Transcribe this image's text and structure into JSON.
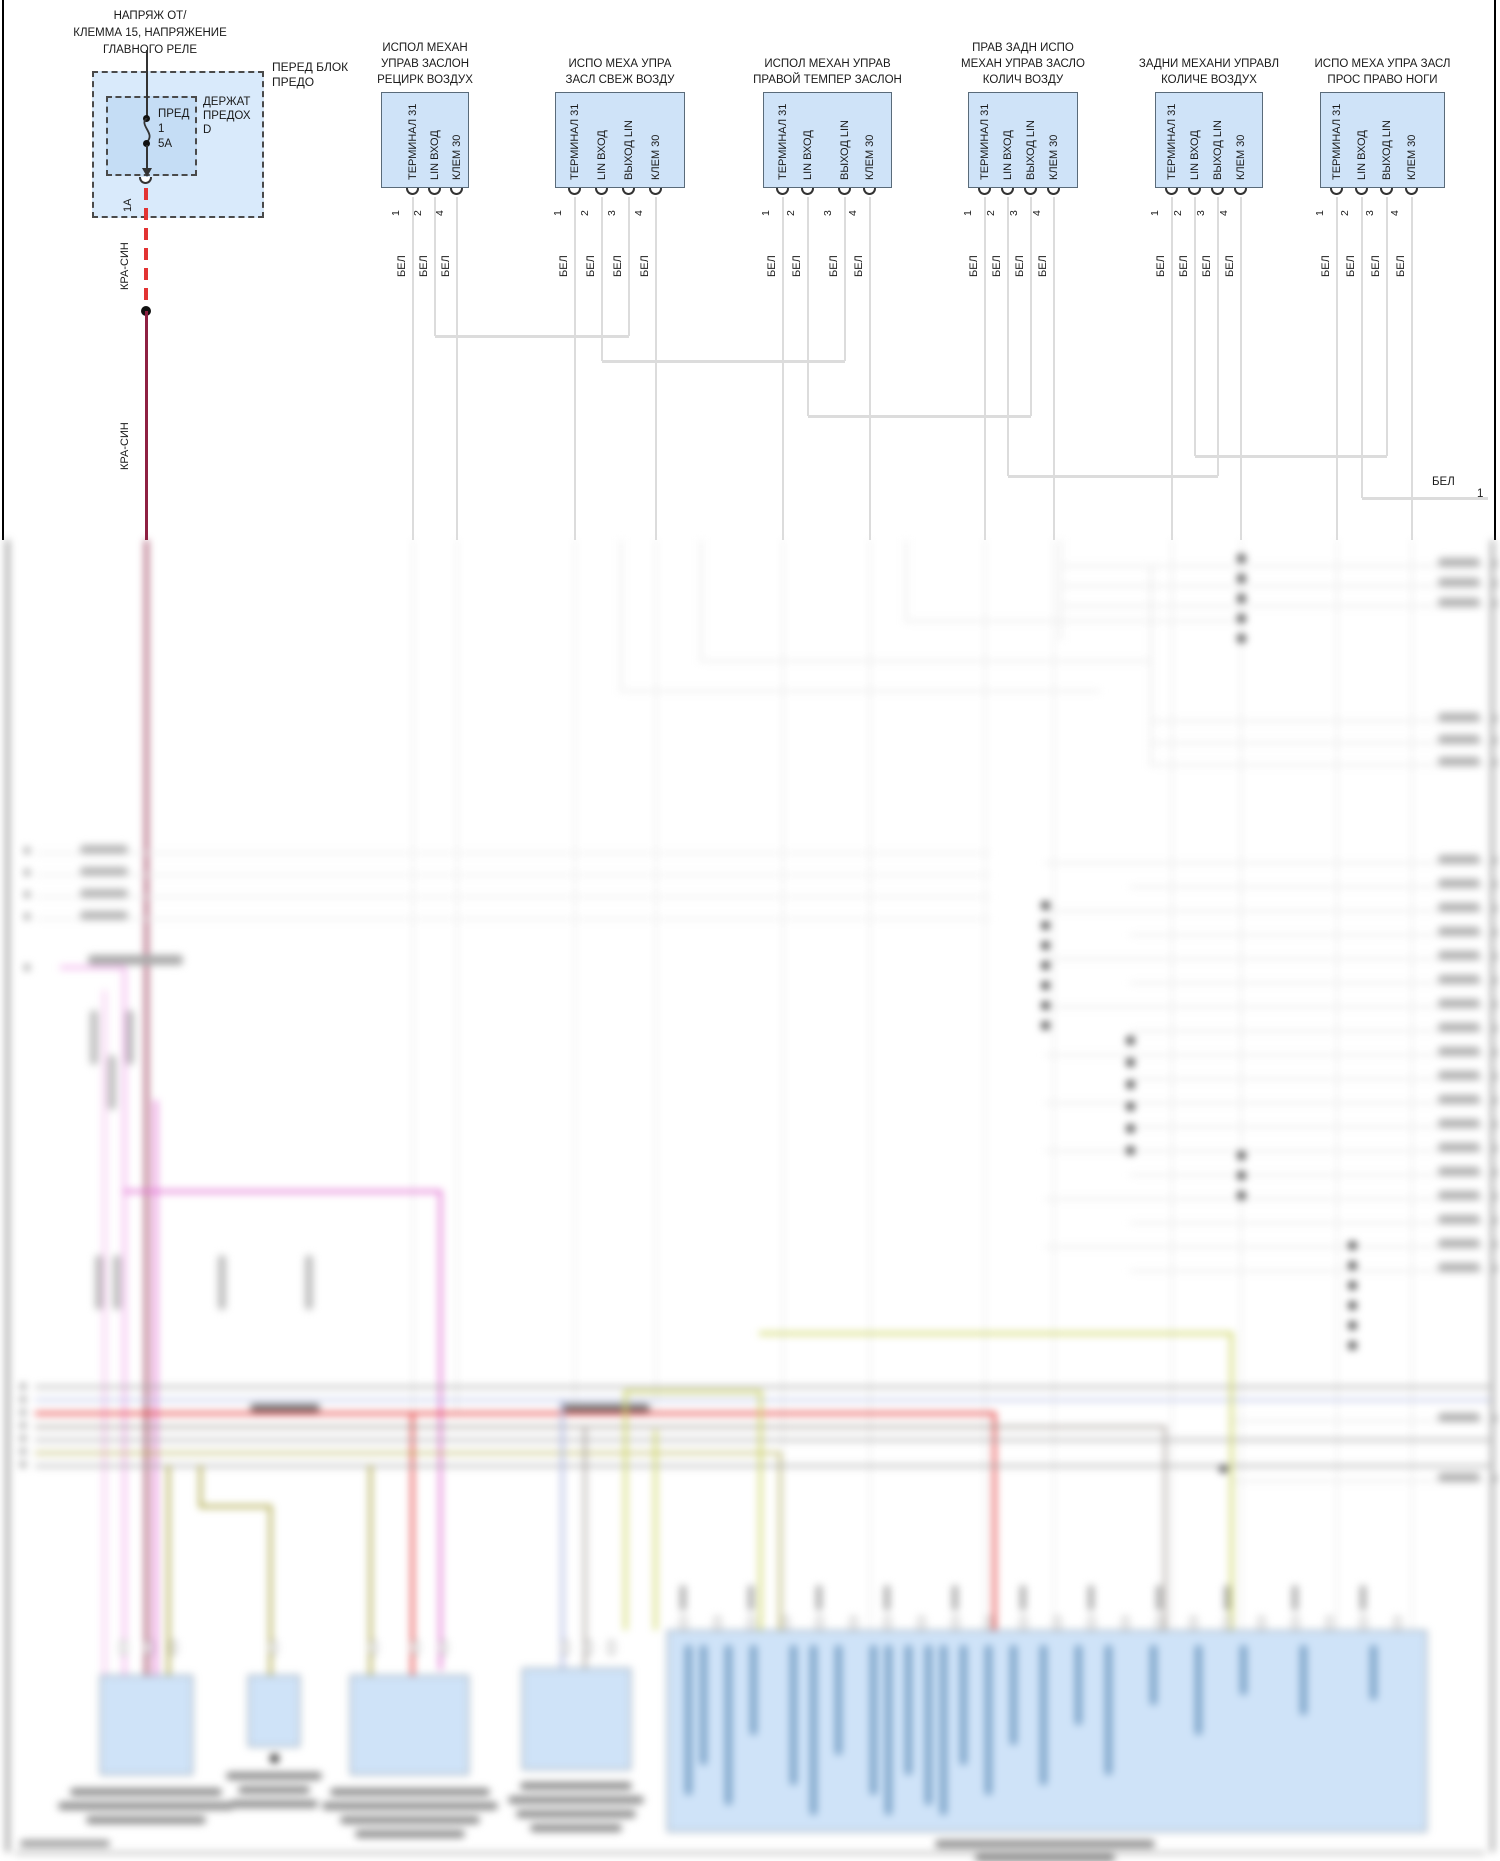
{
  "fuse_block": {
    "source_label": "НАПРЯЖ ОТ/\nКЛЕММА 15, НАПРЯЖЕНИЕ\nГЛАВНОГО РЕЛЕ",
    "box_label": "ПЕРЕД БЛОК\nПРЕДО",
    "holder_label": "ДЕРЖАТ\nПРЕДОХ\nD",
    "fuse_name": "ПРЕД",
    "fuse_number": "1",
    "fuse_rating": "5А",
    "output_pin": "1А",
    "wire_label_dashed": "КРА-СИН",
    "wire_label_solid": "КРА-СИН"
  },
  "actuators": [
    {
      "title": "ИСПОЛ МЕХАН\nУПРАВ ЗАСЛОН\nРЕЦИРК ВОЗДУХ",
      "pins": [
        {
          "num": "1",
          "label": "ТЕРМИНАЛ 31"
        },
        {
          "num": "2",
          "label": "LIN ВХОД"
        },
        {
          "num": "4",
          "label": "КЛЕМ 30"
        }
      ],
      "wire_label": "БЕЛ"
    },
    {
      "title": "ИСПО МЕХА УПРА\nЗАСЛ СВЕЖ ВОЗДУ",
      "pins": [
        {
          "num": "1",
          "label": "ТЕРМИНАЛ 31"
        },
        {
          "num": "2",
          "label": "LIN ВХОД"
        },
        {
          "num": "3",
          "label": "ВЫХОД LIN"
        },
        {
          "num": "4",
          "label": "КЛЕМ 30"
        }
      ],
      "wire_label": "БЕЛ"
    },
    {
      "title": "ИСПОЛ МЕХАН УПРАВ\nПРАВОЙ ТЕМПЕР ЗАСЛОН",
      "pins": [
        {
          "num": "1",
          "label": "ТЕРМИНАЛ 31"
        },
        {
          "num": "2",
          "label": "LIN ВХОД"
        },
        {
          "num": "3",
          "label": "ВЫХОД LIN"
        },
        {
          "num": "4",
          "label": "КЛЕМ 30"
        }
      ],
      "wire_label": "БЕЛ"
    },
    {
      "title": "ПРАВ ЗАДН ИСПО\nМЕХАН УПРАВ ЗАСЛО\nКОЛИЧ ВОЗДУ",
      "pins": [
        {
          "num": "1",
          "label": "ТЕРМИНАЛ 31"
        },
        {
          "num": "2",
          "label": "LIN ВХОД"
        },
        {
          "num": "3",
          "label": "ВЫХОД LIN"
        },
        {
          "num": "4",
          "label": "КЛЕМ 30"
        }
      ],
      "wire_label": "БЕЛ"
    },
    {
      "title": "ЗАДНИ МЕХАНИ УПРАВЛ\nКОЛИЧЕ ВОЗДУХ",
      "pins": [
        {
          "num": "1",
          "label": "ТЕРМИНАЛ 31"
        },
        {
          "num": "2",
          "label": "LIN ВХОД"
        },
        {
          "num": "3",
          "label": "ВЫХОД LIN"
        },
        {
          "num": "4",
          "label": "КЛЕМ 30"
        }
      ],
      "wire_label": "БЕЛ"
    },
    {
      "title": "ИСПО МЕХА УПРА ЗАСЛ\nПРОС ПРАВО НОГИ",
      "pins": [
        {
          "num": "1",
          "label": "ТЕРМИНАЛ 31"
        },
        {
          "num": "2",
          "label": "LIN ВХОД"
        },
        {
          "num": "3",
          "label": "ВЫХОД LIN"
        },
        {
          "num": "4",
          "label": "КЛЕМ 30"
        }
      ],
      "wire_label": "БЕЛ"
    }
  ],
  "exit_wire": {
    "label": "БЕЛ",
    "pin": "1"
  },
  "colors": {
    "wire_white": "#dcdcdc",
    "wire_red": "#e23333",
    "wire_dark_red": "#8e2042",
    "wire_pink": "#f0a8ea",
    "wire_magenta": "#e06ad0",
    "wire_olive": "#a8a23c",
    "wire_khaki": "#ccd45e",
    "wire_lavender": "#aab4e0",
    "box_fill": "#cfe3f8",
    "fuse_outer_fill": "#d9eafb",
    "fuse_inner_fill": "#c5ddf5"
  }
}
